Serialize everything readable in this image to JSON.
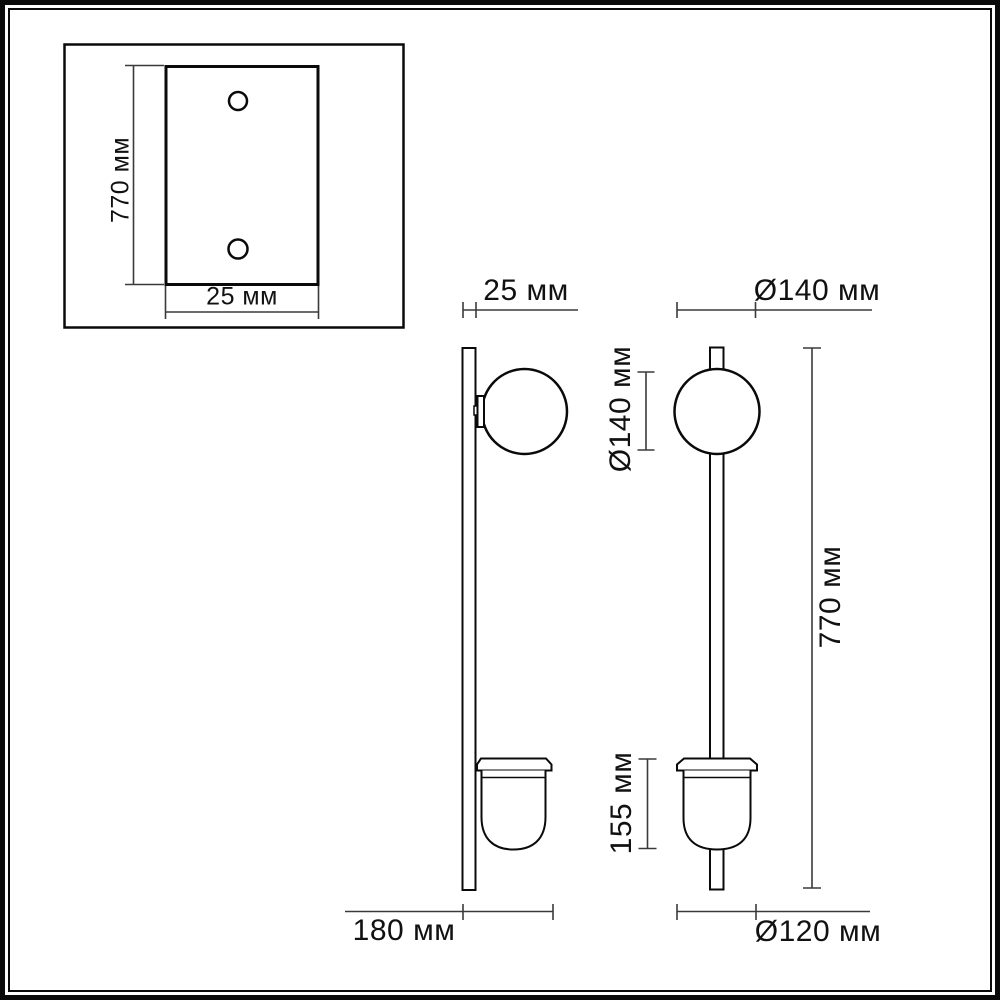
{
  "page": {
    "background_color": "#ffffff",
    "line_color": "#0a0a0a",
    "dimension_line_color": "#3a3a3a",
    "text_color": "#111111"
  },
  "drawing": {
    "back_plate_view": {
      "height_label": "770 мм",
      "width_label": "25 мм"
    },
    "side_view": {
      "plate_thickness_label": "25 мм",
      "depth_label": "180 мм"
    },
    "front_view": {
      "top_diameter_label": "Ø140 мм",
      "globe_diameter_label": "Ø140 мм",
      "shade_height_label": "155 мм",
      "total_height_label": "770 мм",
      "shade_diameter_label": "Ø120 мм"
    }
  }
}
